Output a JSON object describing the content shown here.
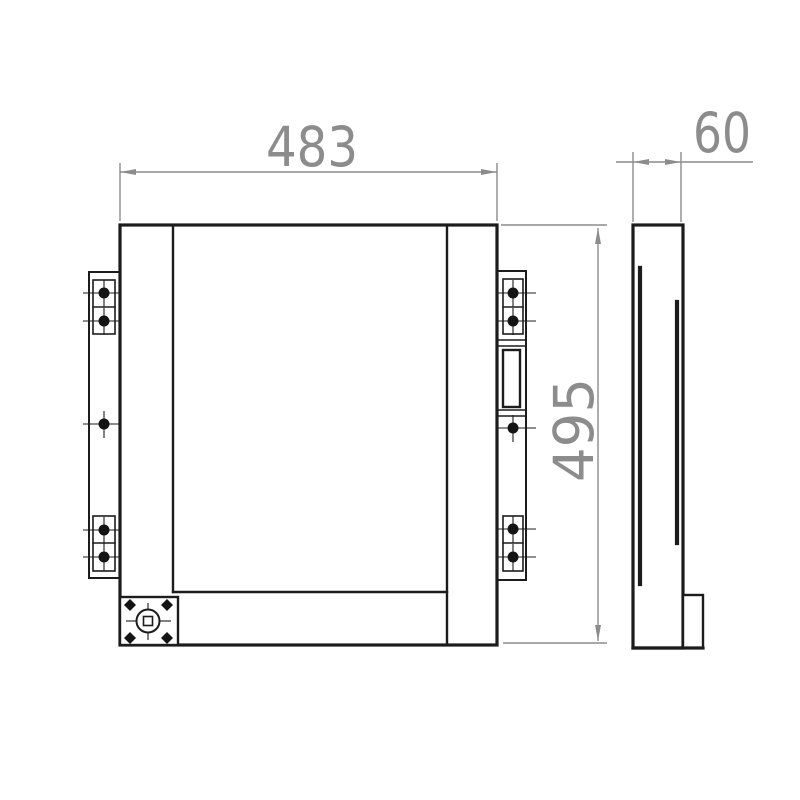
{
  "drawing": {
    "kind": "engineering-dimension-drawing",
    "dimensions": {
      "width_label": "483",
      "depth_label": "60",
      "height_label": "495"
    },
    "colors": {
      "outline": "#1c1c1c",
      "dimension": "#8c8c8c",
      "background": "#ffffff"
    }
  }
}
